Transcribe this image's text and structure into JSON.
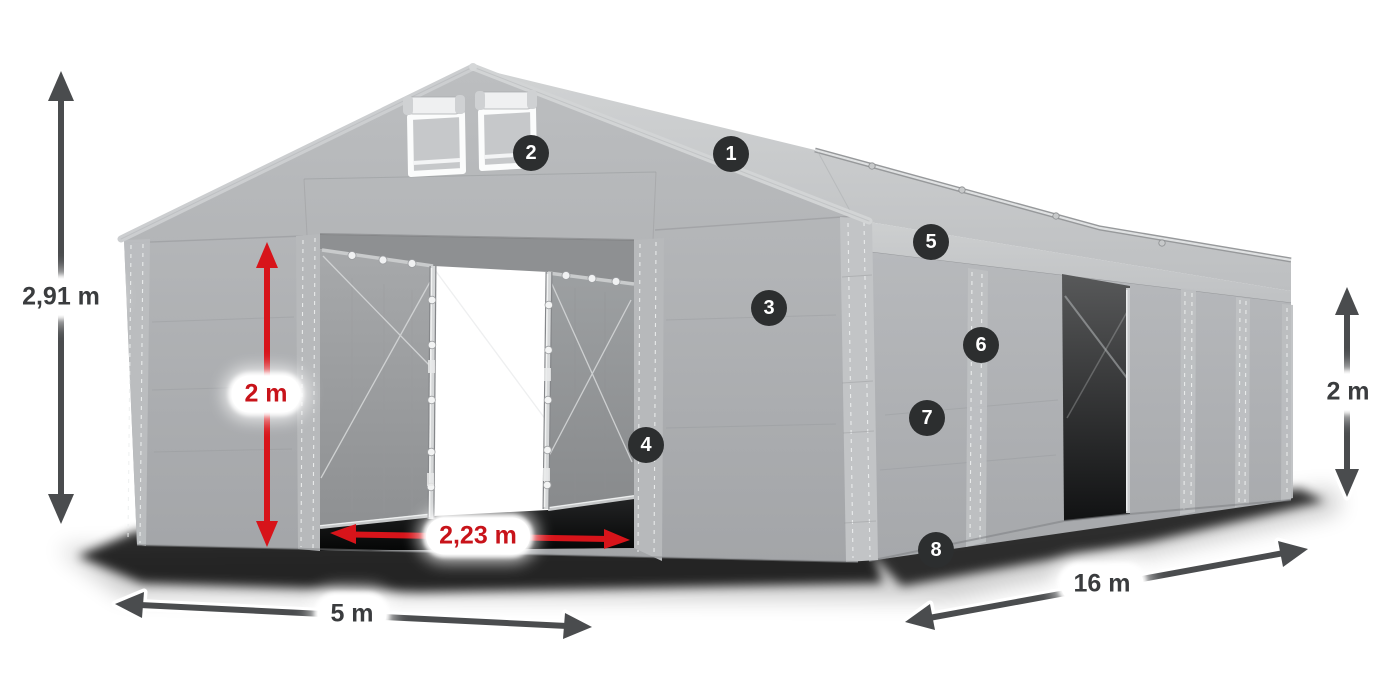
{
  "dimensions": {
    "total_height": {
      "value": "2,91 m",
      "accent": "dark"
    },
    "clearance_height": {
      "value": "2 m",
      "accent": "red"
    },
    "door_width": {
      "value": "2,23 m",
      "accent": "red"
    },
    "width": {
      "value": "5 m",
      "accent": "dark"
    },
    "length": {
      "value": "16 m",
      "accent": "dark"
    },
    "side_height": {
      "value": "2 m",
      "accent": "dark"
    }
  },
  "feature_markers": [
    "1",
    "2",
    "3",
    "4",
    "5",
    "6",
    "7",
    "8"
  ],
  "colors": {
    "background": "#ffffff",
    "tent_fabric": "#aeb0b3",
    "tent_fabric_light": "#c6c8ca",
    "tent_interior_dark": "#1a1b1c",
    "frame_metal": "#d6d8d9",
    "dimension_red": "#d7141a",
    "dimension_dark": "#4a4c4e",
    "label_text": "#3a3c3e",
    "label_background": "#ffffff",
    "marker_background": "#2c2e2f",
    "marker_text": "#ffffff"
  }
}
